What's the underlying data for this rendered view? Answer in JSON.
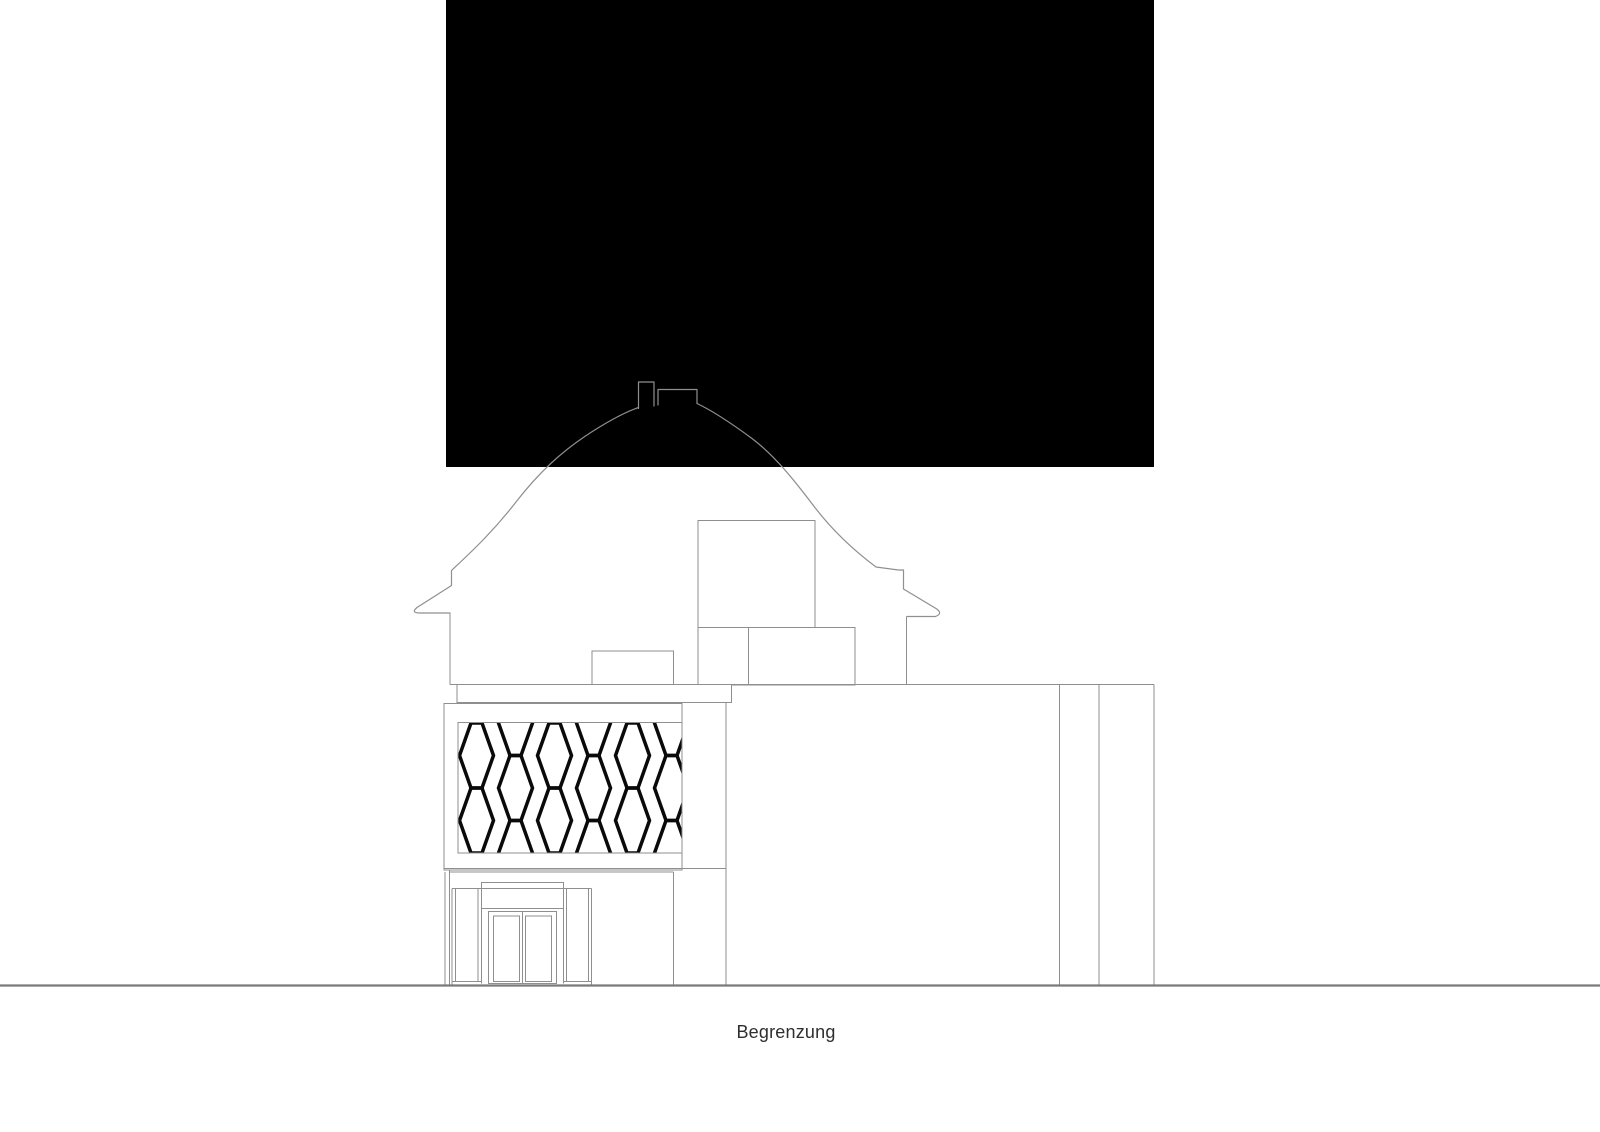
{
  "drawing": {
    "caption": "Begrenzung",
    "colors": {
      "background": "#ffffff",
      "mask_fill": "#000000",
      "line": "#8f8f8f",
      "ground_line": "#7a7a7a",
      "screen_pattern": "#0a0a0a",
      "caption_text": "#2e2e2e"
    }
  }
}
